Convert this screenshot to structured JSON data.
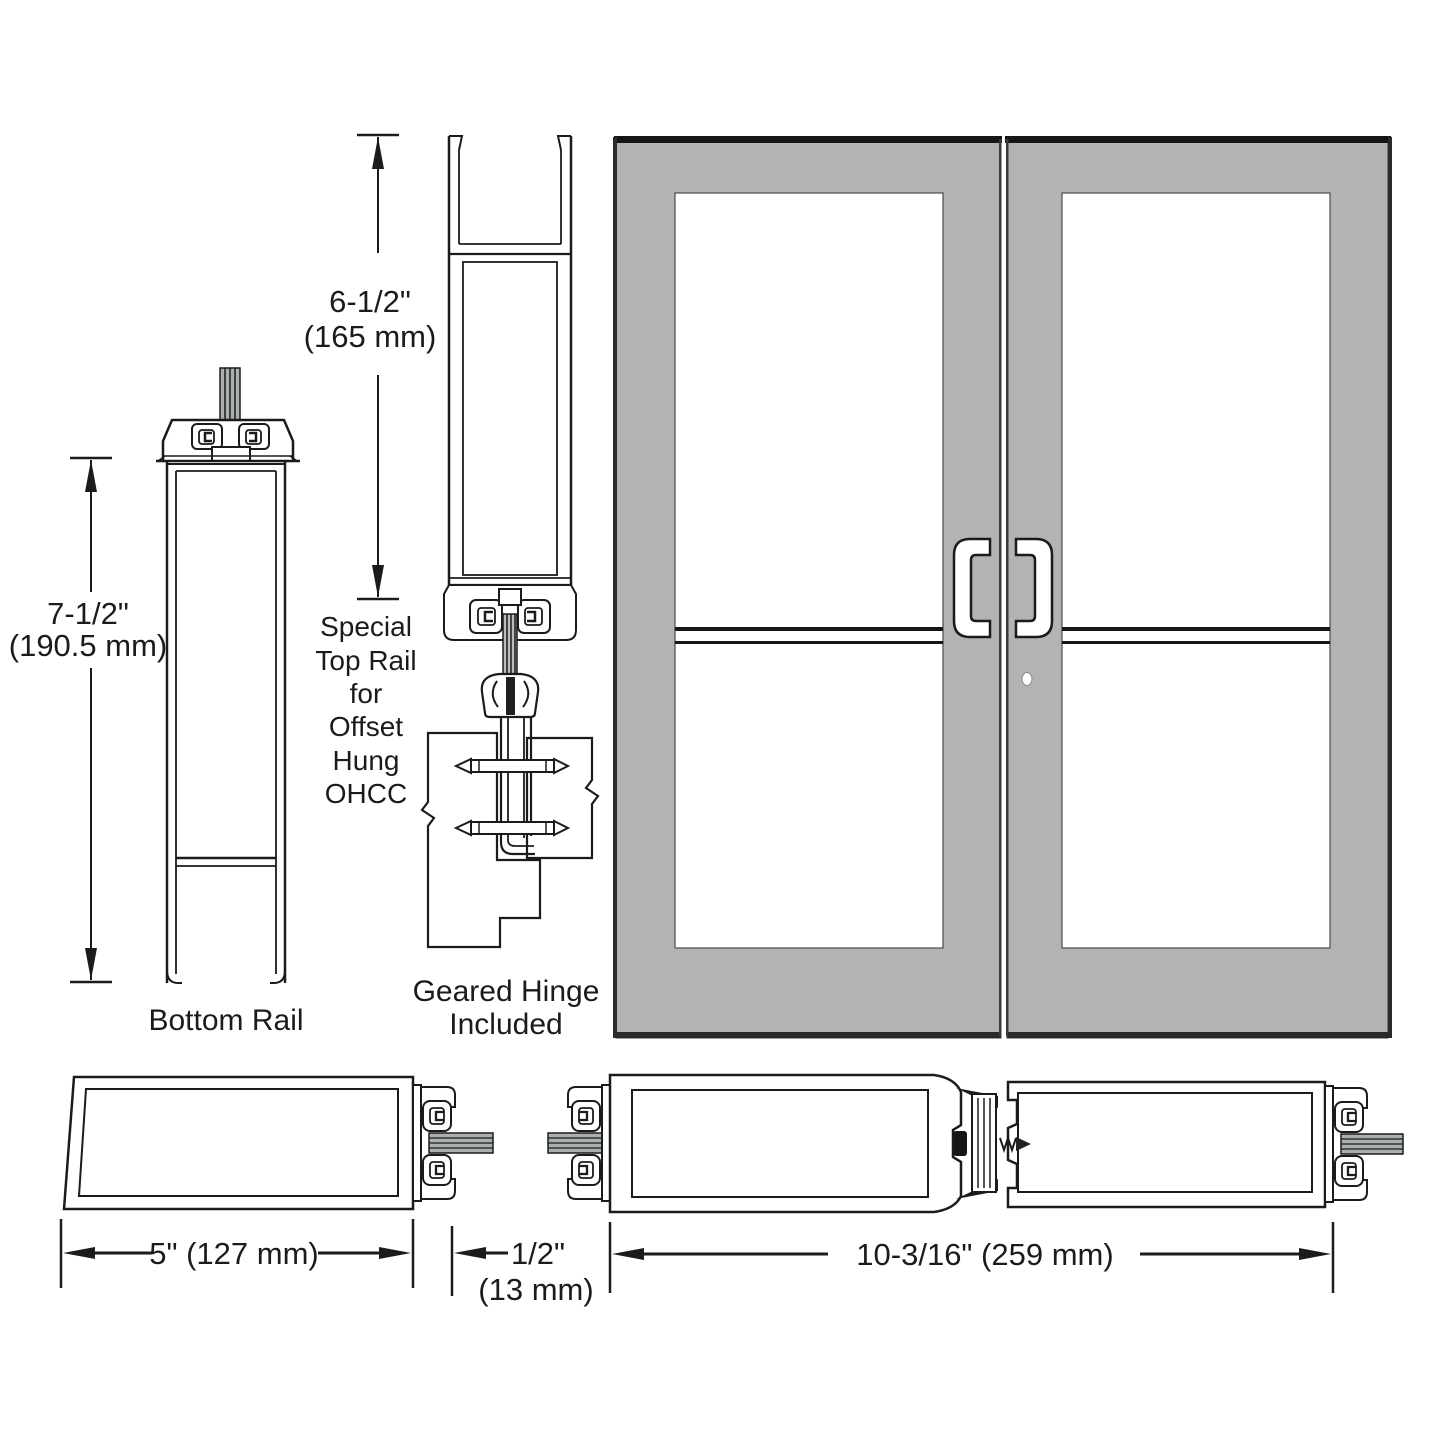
{
  "figure_title": "Storefront door rail and hinge technical diagram",
  "labels": {
    "bottom_rail": "Bottom Rail",
    "special_top_rail_lines": [
      "Special",
      "Top Rail",
      "for",
      "Offset",
      "Hung",
      "OHCC"
    ],
    "geared_hinge_line1": "Geared Hinge",
    "geared_hinge_line2": "Included"
  },
  "dimensions": {
    "bottom_rail_height_in": "7-1/2\"",
    "bottom_rail_height_mm": "(190.5 mm)",
    "top_rail_height_in": "6-1/2\"",
    "top_rail_height_mm": "(165 mm)",
    "stile_width": "5\" (127 mm)",
    "gap_width_in": "1/2\"",
    "gap_width_mm": "(13 mm)",
    "pair_width": "10-3/16\" (259 mm)"
  },
  "colors": {
    "line": "#1b1b1b",
    "door_gray": "#b2b4b1",
    "stub_gray": "#aab0af",
    "edge_black": "#161616"
  }
}
